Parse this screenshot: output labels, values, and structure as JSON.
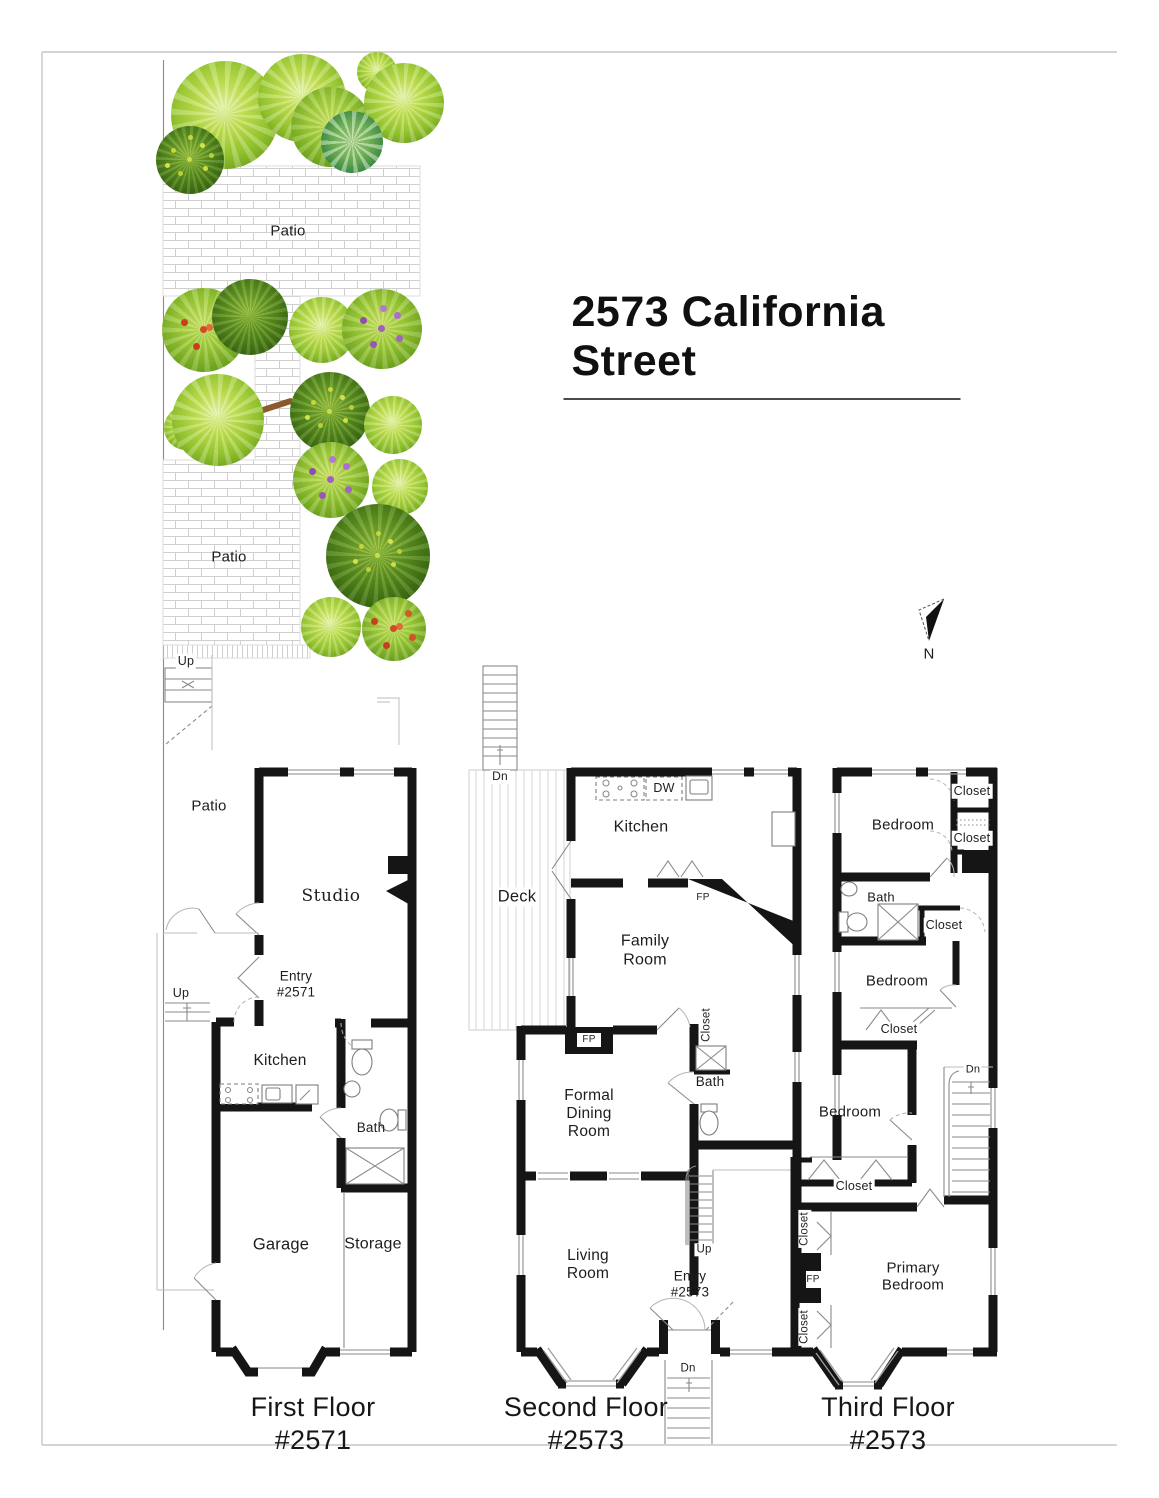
{
  "title": "2573 California Street",
  "compass": {
    "north_label": "N"
  },
  "palette": {
    "wall_color": "#151515",
    "brick_line_color": "#cfcfcf",
    "plant_light_green": "#97c730",
    "plant_dark_green": "#3c6b10",
    "flower_red": "#d14a28",
    "flower_purple": "#a05fc2"
  },
  "garden": {
    "patio_upper_label": "Patio",
    "patio_lower_label": "Patio"
  },
  "floor1": {
    "caption": "First Floor",
    "unit": "#2571",
    "labels": {
      "up_top": "Up",
      "patio": "Patio",
      "studio": "Studio",
      "entry": "Entry",
      "entry_unit": "#2571",
      "up_mid": "Up",
      "kitchen": "Kitchen",
      "bath": "Bath",
      "garage": "Garage",
      "storage": "Storage"
    }
  },
  "floor2": {
    "caption": "Second Floor",
    "unit": "#2573",
    "labels": {
      "dn_top": "Dn",
      "deck": "Deck",
      "dw": "DW",
      "kitchen": "Kitchen",
      "fp_kitchen": "FP",
      "family_room": "Family Room",
      "closet": "Closet",
      "bath": "Bath",
      "fp_dining": "FP",
      "formal_dining_room": "Formal Dining Room",
      "up": "Up",
      "living_room": "Living Room",
      "entry": "Entry",
      "entry_unit": "#2573",
      "dn_bottom": "Dn"
    }
  },
  "floor3": {
    "caption": "Third Floor",
    "unit": "#2573",
    "labels": {
      "bedroom_rear": "Bedroom",
      "closet_1": "Closet",
      "closet_2": "Closet",
      "bath": "Bath",
      "closet_3": "Closet",
      "bedroom_mid": "Bedroom",
      "closet_4": "Closet",
      "bedroom_front": "Bedroom",
      "dn": "Dn",
      "closet_5": "Closet",
      "closet_6": "Closet",
      "fp": "FP",
      "closet_7": "Closet",
      "primary_bedroom": "Primary Bedroom"
    }
  }
}
